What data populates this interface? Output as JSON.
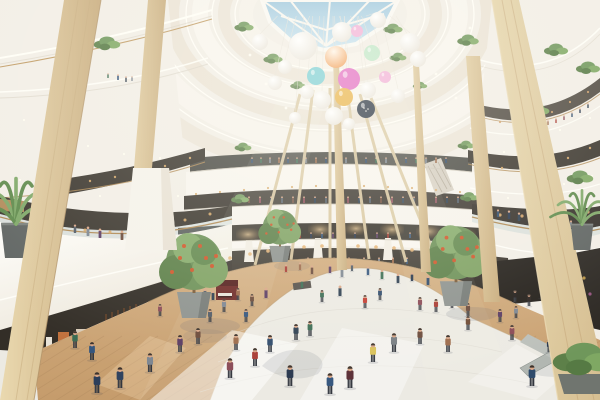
{
  "meta": {
    "scene_description": "Architectural rendering of a multi-storey circular shopping mall atrium with a glazed skylight, hanging balloon decorations, white curved balconies, wooden columns, indoor trees and crowds of shoppers"
  },
  "colors": {
    "background": "#f2eee6",
    "sky_top": "#9fc8de",
    "sky_bottom": "#cde6f2",
    "fascia_white": "#f8f5ee",
    "fascia_shadow": "#ece4d7",
    "wood_column": "#d8c298",
    "wood_floor": "#cfa87a",
    "floor_tile": "#eceae3",
    "shop_dark": "#36322a",
    "warm_light": "#d8a868",
    "plant_green": "#6f975b",
    "fruit_orange": "#d0562a",
    "planter_gray": "#8e938f",
    "handrail_wood": "#b08a55"
  },
  "balloons": {
    "anchor": [
      330,
      16
    ],
    "color_map": {
      "t": "#7ed0d5",
      "p": "#e36fc4",
      "pk": "#f2b3d9",
      "y": "#eab54d",
      "m": "#c2e7c9",
      "n": "#2f3947"
    },
    "items": [
      [
        303,
        46,
        14,
        "w"
      ],
      [
        342,
        32,
        10,
        "w"
      ],
      [
        357,
        31,
        6,
        "pk"
      ],
      [
        336,
        57,
        11,
        "o"
      ],
      [
        316,
        76,
        9,
        "t"
      ],
      [
        349,
        79,
        11,
        "p"
      ],
      [
        372,
        53,
        8,
        "m"
      ],
      [
        344,
        97,
        9,
        "y"
      ],
      [
        368,
        90,
        8,
        "w"
      ],
      [
        322,
        100,
        9,
        "w"
      ],
      [
        307,
        92,
        7,
        "w"
      ],
      [
        366,
        109,
        9,
        "n"
      ],
      [
        334,
        116,
        9,
        "w"
      ],
      [
        349,
        124,
        6,
        "w"
      ],
      [
        385,
        77,
        6,
        "pk"
      ],
      [
        378,
        20,
        8,
        "w"
      ],
      [
        410,
        43,
        10,
        "w"
      ],
      [
        418,
        59,
        8,
        "w"
      ],
      [
        285,
        67,
        7,
        "w"
      ],
      [
        275,
        83,
        7,
        "w"
      ],
      [
        295,
        118,
        6,
        "w"
      ],
      [
        260,
        42,
        8,
        "w"
      ],
      [
        398,
        96,
        7,
        "w"
      ]
    ]
  },
  "crowd": {
    "skin": "#d9a687",
    "hair": "#3a322c",
    "palette": [
      "#2e4a6b",
      "#515b66",
      "#a83a32",
      "#3a6b52",
      "#6b4a3a",
      "#27364d",
      "#7d8691",
      "#8a4a56",
      "#34557d",
      "#9c6a4a",
      "#2c3e50",
      "#5a3c63"
    ],
    "far_rows": [
      {
        "y": 163,
        "h": 6,
        "xs": [
          252,
          261,
          270,
          279,
          288,
          297,
          306,
          316,
          326,
          336,
          346,
          356,
          366,
          376,
          386,
          396,
          406,
          416,
          426,
          436,
          446
        ]
      },
      {
        "y": 203,
        "h": 7,
        "xs": [
          238,
          249,
          260,
          271,
          282,
          293,
          304,
          315,
          326,
          337,
          348,
          359,
          370,
          381,
          392,
          403,
          414,
          425,
          436,
          447,
          458
        ]
      },
      {
        "y": 238,
        "h": 6,
        "xs": [
          300,
          311,
          322,
          333,
          344,
          355,
          366,
          377,
          388,
          399,
          410,
          421
        ]
      },
      {
        "y": 264,
        "h": 7,
        "xs": [
          308,
          321,
          334,
          349,
          364,
          379,
          393,
          407
        ]
      }
    ],
    "balcony": [
      [
        75,
        233,
        9
      ],
      [
        88,
        236,
        10
      ],
      [
        100,
        238,
        10
      ],
      [
        122,
        240,
        10
      ],
      [
        131,
        240,
        10
      ],
      [
        141,
        240,
        10
      ],
      [
        154,
        239,
        9
      ],
      [
        498,
        217,
        8
      ],
      [
        509,
        219,
        9
      ],
      [
        519,
        221,
        9
      ],
      [
        531,
        223,
        9,
        "#8a2f2f"
      ],
      [
        545,
        226,
        9
      ],
      [
        558,
        227,
        9
      ],
      [
        571,
        228,
        8
      ],
      [
        584,
        228,
        8
      ],
      [
        540,
        126,
        5
      ],
      [
        548,
        125,
        5
      ],
      [
        556,
        123,
        5
      ],
      [
        564,
        120,
        5
      ],
      [
        572,
        117,
        5
      ],
      [
        580,
        113,
        5
      ],
      [
        588,
        108,
        5
      ],
      [
        108,
        78,
        5
      ],
      [
        118,
        80,
        6
      ],
      [
        126,
        82,
        6
      ],
      [
        132,
        81,
        5
      ]
    ],
    "mid": [
      [
        286,
        272,
        8
      ],
      [
        300,
        270,
        8
      ],
      [
        312,
        274,
        9
      ],
      [
        330,
        273,
        9
      ],
      [
        342,
        277,
        10
      ],
      [
        352,
        271,
        8
      ],
      [
        368,
        275,
        9
      ],
      [
        382,
        279,
        10
      ],
      [
        398,
        283,
        10
      ],
      [
        412,
        281,
        9
      ],
      [
        428,
        285,
        10
      ],
      [
        160,
        316,
        12
      ],
      [
        184,
        308,
        12
      ],
      [
        238,
        300,
        12
      ],
      [
        252,
        306,
        12
      ],
      [
        266,
        298,
        11
      ],
      [
        224,
        312,
        13
      ],
      [
        210,
        322,
        13
      ],
      [
        246,
        322,
        13
      ],
      [
        322,
        302,
        12
      ],
      [
        340,
        296,
        11
      ],
      [
        365,
        308,
        13,
        "#c23b30"
      ],
      [
        380,
        300,
        12
      ],
      [
        420,
        310,
        13
      ],
      [
        436,
        312,
        13
      ],
      [
        452,
        308,
        12
      ],
      [
        468,
        316,
        13
      ],
      [
        500,
        322,
        13
      ],
      [
        516,
        318,
        12
      ],
      [
        205,
        298,
        10
      ],
      [
        213,
        300,
        10,
        "#2c3e50"
      ],
      [
        302,
        288,
        9
      ],
      [
        515,
        302,
        12,
        "#241f1d"
      ],
      [
        529,
        306,
        12,
        "#2b2420"
      ],
      [
        541,
        298,
        11,
        "#201c19"
      ]
    ],
    "near": [
      [
        75,
        348,
        17
      ],
      [
        92,
        360,
        18
      ],
      [
        120,
        388,
        21,
        "#31435f"
      ],
      [
        150,
        372,
        19
      ],
      [
        180,
        352,
        17
      ],
      [
        198,
        344,
        16
      ],
      [
        236,
        350,
        16
      ],
      [
        255,
        366,
        18
      ],
      [
        230,
        378,
        20
      ],
      [
        270,
        352,
        17
      ],
      [
        290,
        386,
        21
      ],
      [
        296,
        340,
        16
      ],
      [
        310,
        336,
        15
      ],
      [
        330,
        394,
        21
      ],
      [
        350,
        388,
        22,
        "#5a2d35"
      ],
      [
        373,
        362,
        19,
        "#d9c158"
      ],
      [
        394,
        352,
        19,
        "#777d82"
      ],
      [
        420,
        344,
        16
      ],
      [
        448,
        352,
        17
      ],
      [
        468,
        330,
        14,
        "#6e4a33"
      ],
      [
        512,
        340,
        15
      ],
      [
        532,
        386,
        21
      ],
      [
        549,
        352,
        13
      ],
      [
        566,
        346,
        12
      ],
      [
        594,
        366,
        15
      ],
      [
        97,
        393,
        21,
        "#2c3e5a"
      ]
    ]
  },
  "lights": {
    "f3_shops": {
      "color": "#d8a868",
      "r": 1.1,
      "pts": [
        [
          196,
          194
        ],
        [
          220,
          192
        ],
        [
          244,
          190
        ],
        [
          268,
          188
        ],
        [
          292,
          187
        ],
        [
          316,
          186
        ],
        [
          340,
          186
        ],
        [
          364,
          186
        ],
        [
          388,
          187
        ],
        [
          412,
          188
        ],
        [
          436,
          190
        ],
        [
          460,
          192
        ]
      ]
    },
    "ground_shops": {
      "color": "#e4b172",
      "r": 1.8,
      "pts": [
        [
          190,
          268
        ],
        [
          210,
          262
        ],
        [
          230,
          258
        ],
        [
          250,
          254
        ],
        [
          268,
          251
        ],
        [
          286,
          249
        ],
        [
          304,
          247
        ],
        [
          322,
          246
        ],
        [
          340,
          246
        ],
        [
          358,
          246
        ],
        [
          376,
          247
        ],
        [
          394,
          248
        ],
        [
          412,
          250
        ],
        [
          430,
          252
        ],
        [
          448,
          255
        ],
        [
          466,
          259
        ],
        [
          484,
          264
        ]
      ]
    },
    "left2f_shops": {
      "color": "#d8a868",
      "r": 1.5,
      "pts": [
        [
          210,
          214
        ],
        [
          185,
          220
        ],
        [
          160,
          226
        ],
        [
          135,
          230
        ],
        [
          110,
          232
        ],
        [
          85,
          230
        ],
        [
          60,
          227
        ],
        [
          35,
          222
        ]
      ]
    },
    "left3f_shops": {
      "color": "#d8a868",
      "r": 1.2,
      "pts": [
        [
          190,
          158
        ],
        [
          165,
          166
        ],
        [
          140,
          172
        ],
        [
          115,
          177
        ],
        [
          90,
          181
        ],
        [
          68,
          184
        ]
      ]
    },
    "right2f_shops": {
      "color": "#dca86a",
      "r": 1.6,
      "pts": [
        [
          588,
          212
        ],
        [
          566,
          214
        ],
        [
          544,
          215
        ],
        [
          522,
          216
        ],
        [
          500,
          215
        ],
        [
          484,
          213
        ]
      ]
    },
    "right3f_shops": {
      "color": "#d8a868",
      "r": 1.2,
      "pts": [
        [
          590,
          148
        ],
        [
          568,
          158
        ],
        [
          546,
          166
        ],
        [
          524,
          170
        ],
        [
          502,
          168
        ],
        [
          486,
          160
        ]
      ]
    },
    "right4f_shops": {
      "color": "#d0a068",
      "r": 1.1,
      "pts": [
        [
          588,
          92
        ],
        [
          570,
          102
        ],
        [
          552,
          112
        ],
        [
          534,
          120
        ],
        [
          516,
          124
        ],
        [
          500,
          122
        ]
      ]
    },
    "dome_spots": {
      "color": "#fffdf4",
      "r": 1.4,
      "pts": [
        [
          250,
          55
        ],
        [
          266,
          84
        ],
        [
          286,
          108
        ],
        [
          243,
          32
        ],
        [
          416,
          52
        ],
        [
          436,
          74
        ],
        [
          456,
          98
        ],
        [
          470,
          28
        ]
      ]
    },
    "left_fascia": {
      "color": "#fffdf0",
      "r": 1.1,
      "pts": [
        [
          24,
          120
        ],
        [
          56,
          134
        ],
        [
          88,
          146
        ],
        [
          124,
          154
        ],
        [
          160,
          158
        ],
        [
          20,
          180
        ],
        [
          60,
          190
        ],
        [
          100,
          196
        ],
        [
          140,
          198
        ],
        [
          178,
          196
        ]
      ]
    },
    "right_fascia": {
      "color": "#fffdf0",
      "r": 1.1,
      "pts": [
        [
          590,
          118
        ],
        [
          560,
          130
        ],
        [
          530,
          142
        ],
        [
          504,
          152
        ],
        [
          592,
          176
        ],
        [
          564,
          184
        ],
        [
          536,
          192
        ],
        [
          508,
          198
        ]
      ]
    },
    "shelves": {
      "color": "#b05048",
      "r": 1.6,
      "pts": [
        [
          576,
          270
        ],
        [
          584,
          278,
          "#c8a04a"
        ],
        [
          572,
          286,
          "#5878a0"
        ],
        [
          590,
          294,
          "#a05888"
        ],
        [
          578,
          300,
          "#70a070"
        ]
      ]
    }
  },
  "glow_rects": [
    [
      200,
      231
    ],
    [
      236,
      228
    ],
    [
      272,
      225
    ],
    [
      308,
      223
    ],
    [
      344,
      222
    ],
    [
      380,
      223
    ],
    [
      416,
      225
    ],
    [
      452,
      228
    ]
  ],
  "plants": {
    "tufts": [
      [
        107,
        48,
        1.1
      ],
      [
        244,
        30,
        0.8
      ],
      [
        273,
        62,
        0.8
      ],
      [
        298,
        88,
        0.65
      ],
      [
        393,
        32,
        0.8
      ],
      [
        398,
        60,
        0.7
      ],
      [
        420,
        88,
        0.6
      ],
      [
        468,
        44,
        0.9
      ],
      [
        556,
        54,
        1.0
      ],
      [
        588,
        72,
        1.0
      ],
      [
        538,
        114,
        0.95
      ],
      [
        580,
        182,
        1.1
      ],
      [
        243,
        150,
        0.7
      ],
      [
        466,
        148,
        0.7
      ],
      [
        240,
        202,
        0.75
      ],
      [
        469,
        200,
        0.75
      ],
      [
        163,
        232,
        1.0
      ]
    ],
    "palm_left": [
      16,
      258,
      2.0
    ],
    "palm_right": [
      582,
      250,
      1.5
    ],
    "corner_planter": [
      584,
      394,
      2.0
    ]
  },
  "trees": {
    "back": [
      [
        280,
        262,
        0.62
      ]
    ],
    "front": [
      [
        194,
        318,
        1.0
      ],
      [
        456,
        306,
        0.95
      ]
    ]
  }
}
